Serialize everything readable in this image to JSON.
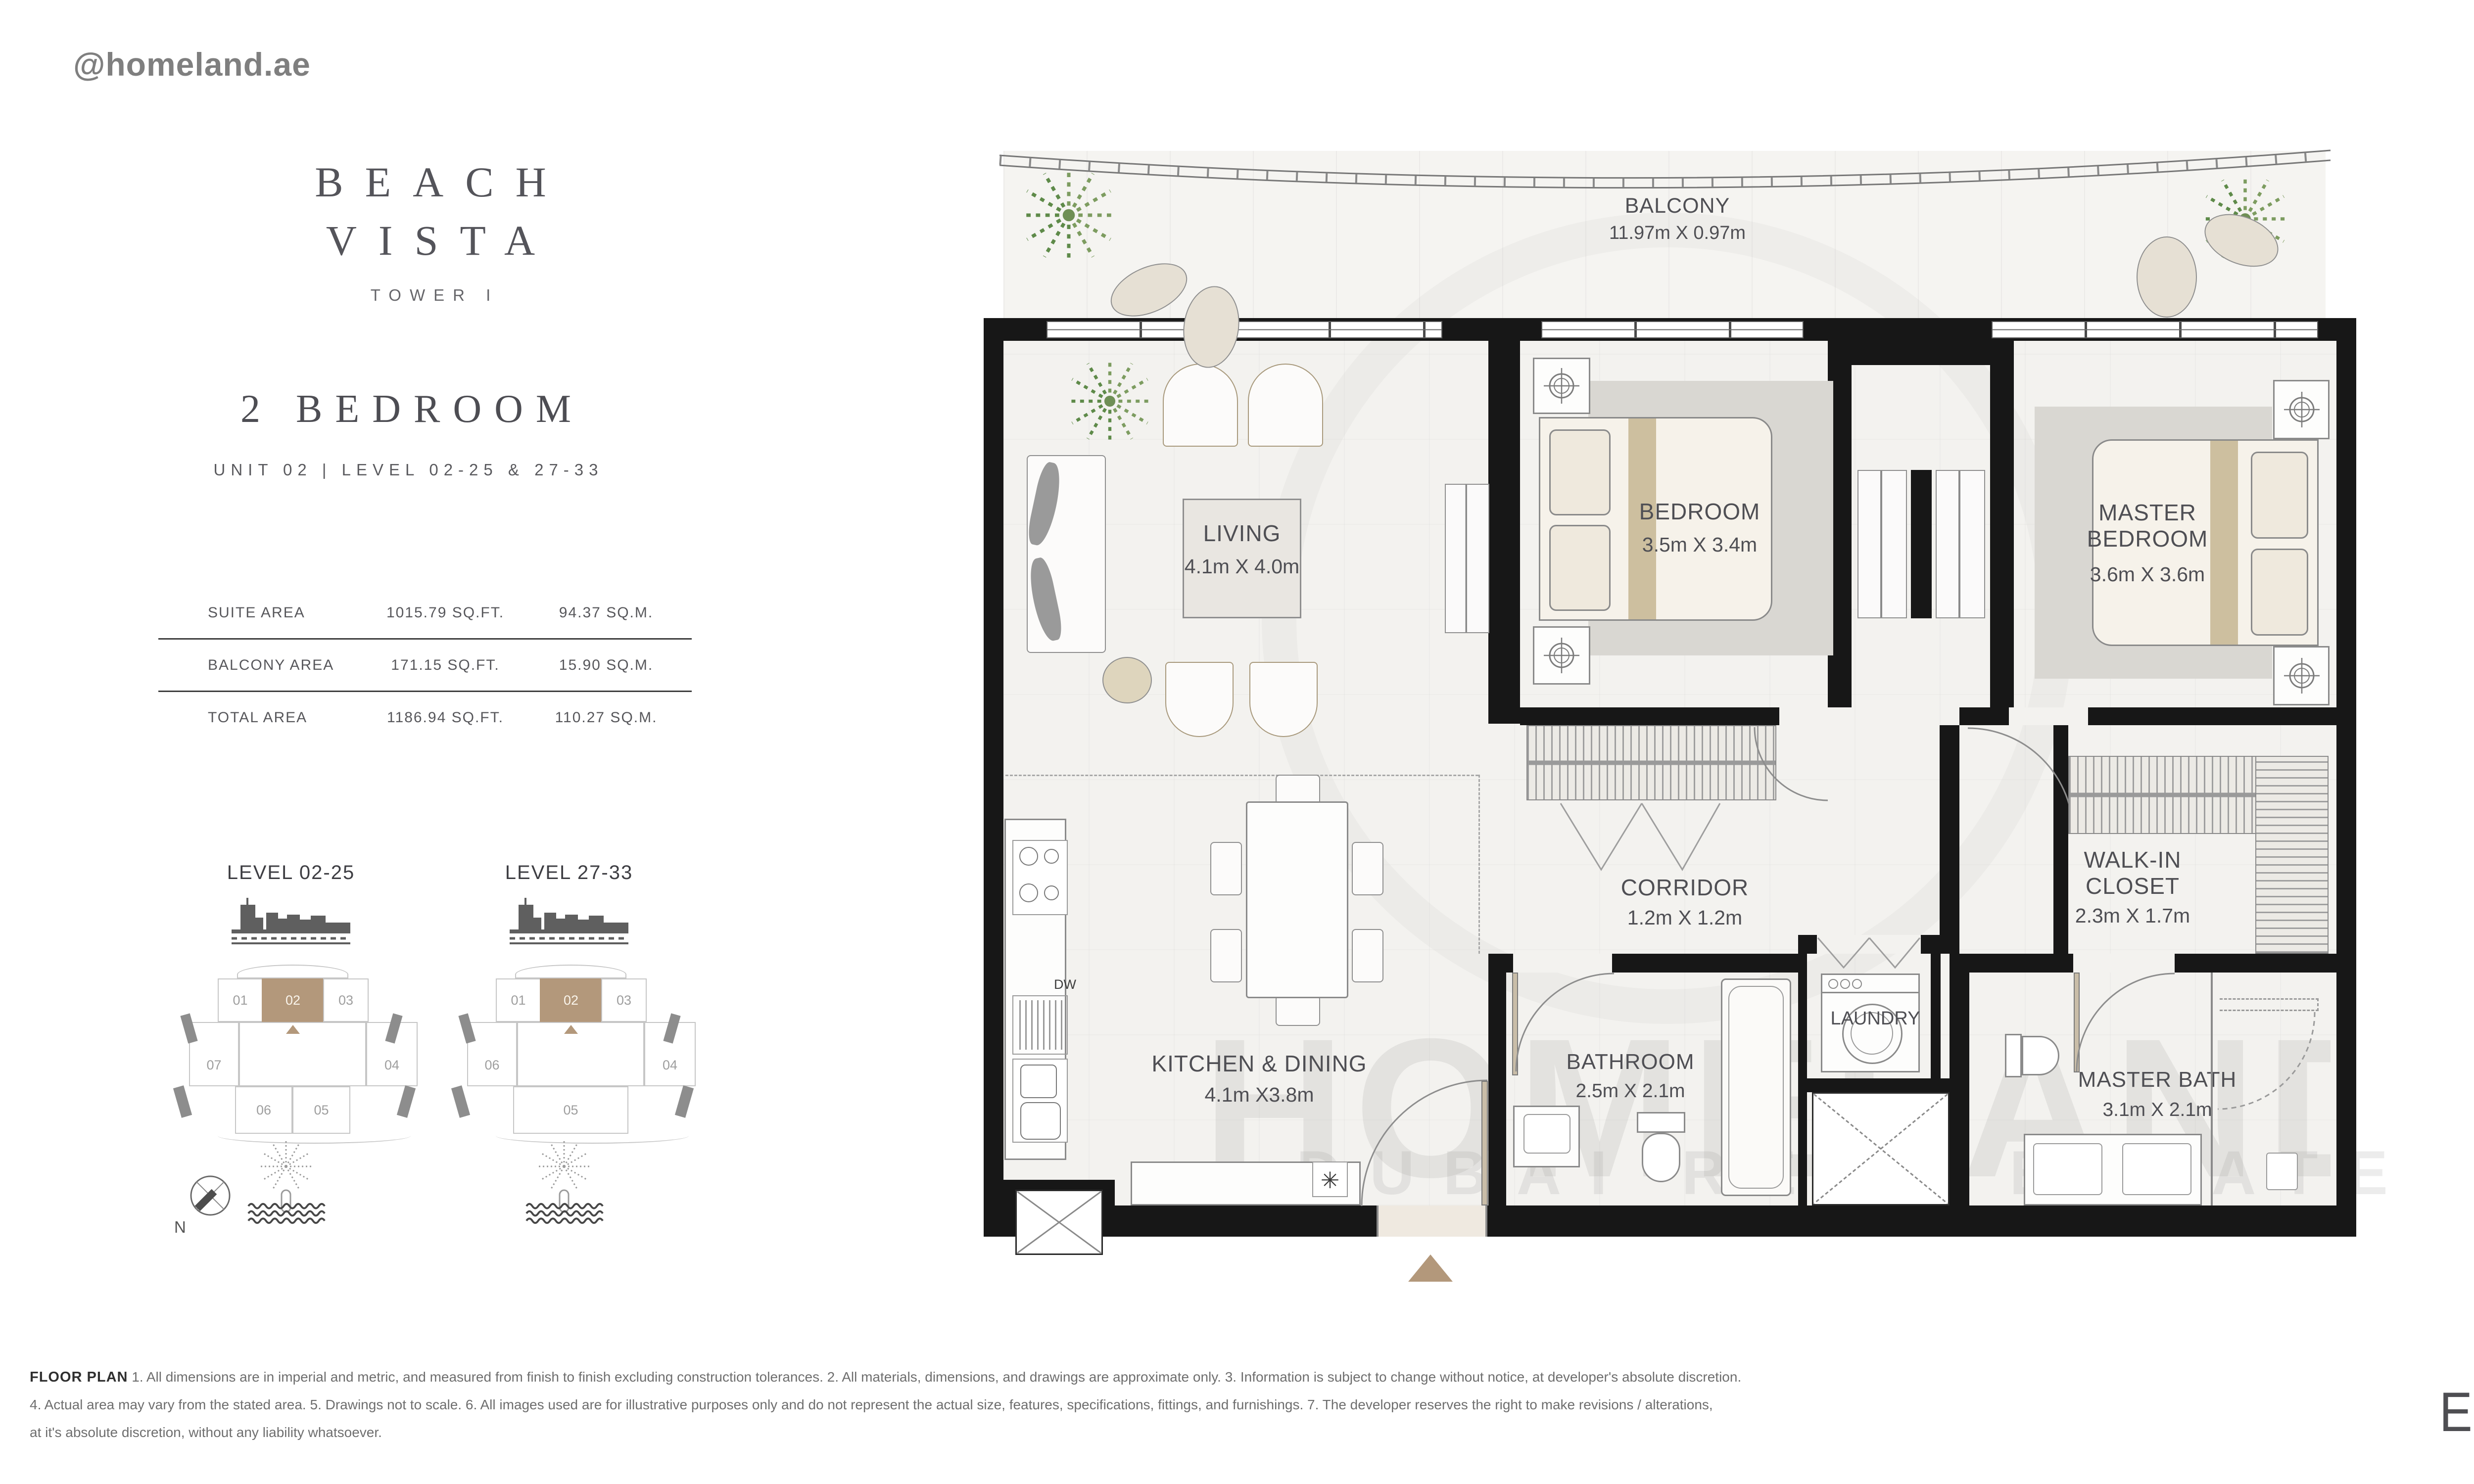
{
  "header": {
    "handle": "@homeland.ae"
  },
  "project": {
    "title_line1": "BEACH",
    "title_line2": "VISTA",
    "tower": "TOWER I",
    "unit_type": "2 BEDROOM",
    "unit_info": "UNIT 02 | LEVEL 02-25 & 27-33"
  },
  "areas": {
    "rows": [
      {
        "label": "SUITE AREA",
        "sqft": "1015.79 SQ.FT.",
        "sqm": "94.37 SQ.M."
      },
      {
        "label": "BALCONY AREA",
        "sqft": "171.15 SQ.FT.",
        "sqm": "15.90 SQ.M."
      },
      {
        "label": "TOTAL AREA",
        "sqft": "1186.94 SQ.FT.",
        "sqm": "110.27 SQ.M."
      }
    ]
  },
  "keyplans": [
    {
      "title": "LEVEL 02-25",
      "units": {
        "t1": "01",
        "t2": "02",
        "t3": "03",
        "left": "07",
        "right": "04",
        "b1": "06",
        "b2": "05"
      }
    },
    {
      "title": "LEVEL 27-33",
      "units": {
        "t1": "01",
        "t2": "02",
        "t3": "03",
        "left": "06",
        "right": "04",
        "b1": "05"
      }
    }
  ],
  "compass": {
    "north": "N"
  },
  "plan": {
    "balcony": {
      "name": "BALCONY",
      "dims": "11.97m X 0.97m"
    },
    "living": {
      "name": "LIVING",
      "dims": "4.1m X 4.0m"
    },
    "bedroom": {
      "name": "BEDROOM",
      "dims": "3.5m X 3.4m"
    },
    "master_bedroom": {
      "name": "MASTER BEDROOM",
      "dims": "3.6m X 3.6m"
    },
    "kitchen": {
      "name": "KITCHEN & DINING",
      "dims": "4.1m X3.8m"
    },
    "corridor": {
      "name": "CORRIDOR",
      "dims": "1.2m X 1.2m"
    },
    "walk_in": {
      "name": "WALK-IN CLOSET",
      "dims": "2.3m X 1.7m"
    },
    "bathroom": {
      "name": "BATHROOM",
      "dims": "2.5m X 2.1m"
    },
    "master_bath": {
      "name": "MASTER BATH",
      "dims": "3.1m X 2.1m"
    },
    "laundry": {
      "name": "LAUNDRY"
    },
    "dw_label": "DW",
    "vent_icon": "✳"
  },
  "watermark": {
    "main": "HOMELAND",
    "sub": "DUBAI REAL ESTATE"
  },
  "disclaimer": {
    "heading": "FLOOR PLAN",
    "line1": "1. All dimensions are in imperial and metric, and measured from finish to finish excluding construction tolerances. 2. All materials, dimensions, and drawings are approximate only. 3. Information is subject to change without notice, at developer's absolute discretion.",
    "line2": "4. Actual area may vary from the stated area. 5. Drawings not to scale. 6. All images used are for illustrative purposes only and do not represent the actual size, features, specifications, fittings, and furnishings. 7. The developer reserves the right to make revisions / alterations,",
    "line3": "at it's absolute discretion, without any liability whatsoever."
  },
  "brand": {
    "developer": "EMAAR"
  },
  "colors": {
    "accent_tan": "#b3987b",
    "wall": "#171717",
    "floor": "#f3f2ef",
    "rug": "#d9d7d2",
    "palm_green": "#7d9c60",
    "text_dark": "#4f4f54"
  }
}
